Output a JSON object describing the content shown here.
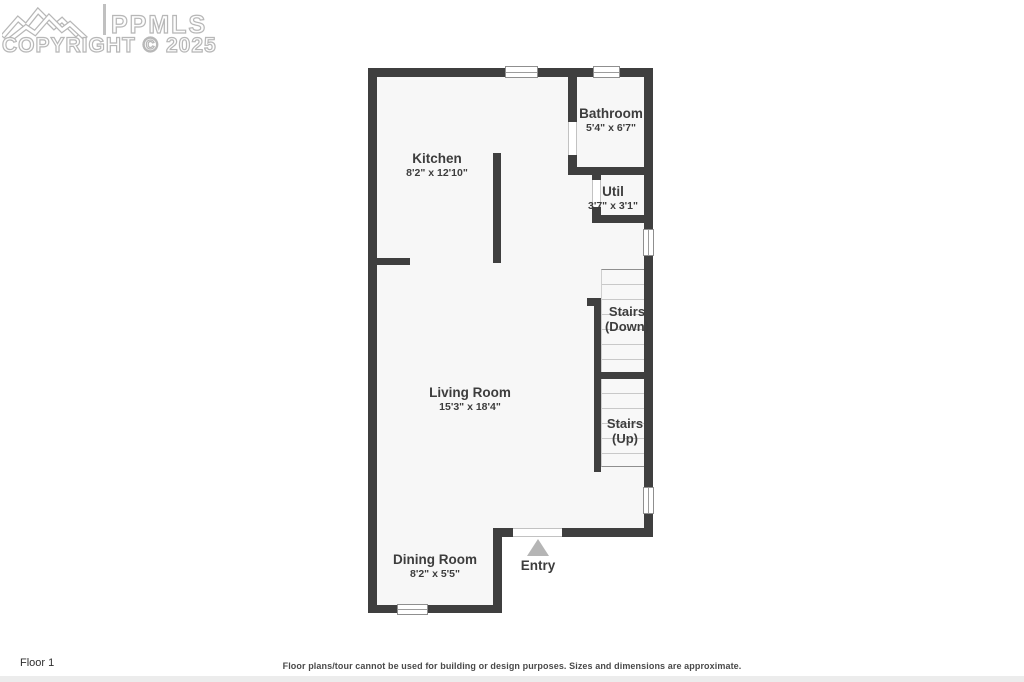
{
  "watermark": {
    "brand": "PPMLS",
    "copyright": "COPYRIGHT © 2025"
  },
  "rooms": {
    "kitchen": {
      "name": "Kitchen",
      "dims": "8'2\" x 12'10\""
    },
    "bathroom": {
      "name": "Bathroom",
      "dims": "5'4\" x 6'7\""
    },
    "util": {
      "name": "Util",
      "dims": "3'7\" x 3'1\""
    },
    "living": {
      "name": "Living Room",
      "dims": "15'3\" x 18'4\""
    },
    "dining": {
      "name": "Dining Room",
      "dims": "8'2\" x 5'5\""
    }
  },
  "stairs": {
    "down": {
      "line1": "Stairs",
      "line2": "(Down)"
    },
    "up": {
      "line1": "Stairs",
      "line2": "(Up)"
    }
  },
  "entry": {
    "label": "Entry"
  },
  "footer": {
    "floor_label": "Floor 1",
    "disclaimer": "Floor plans/tour cannot be used for building or design purposes. Sizes and dimensions are approximate."
  },
  "colors": {
    "wall": "#3f3f3f",
    "floor": "#f7f7f7",
    "tread_line": "#c9c9c9",
    "watermark_outline": "#b7b7b7",
    "entry_arrow": "#b5b5b5",
    "label_text": "#3d3d3d"
  }
}
